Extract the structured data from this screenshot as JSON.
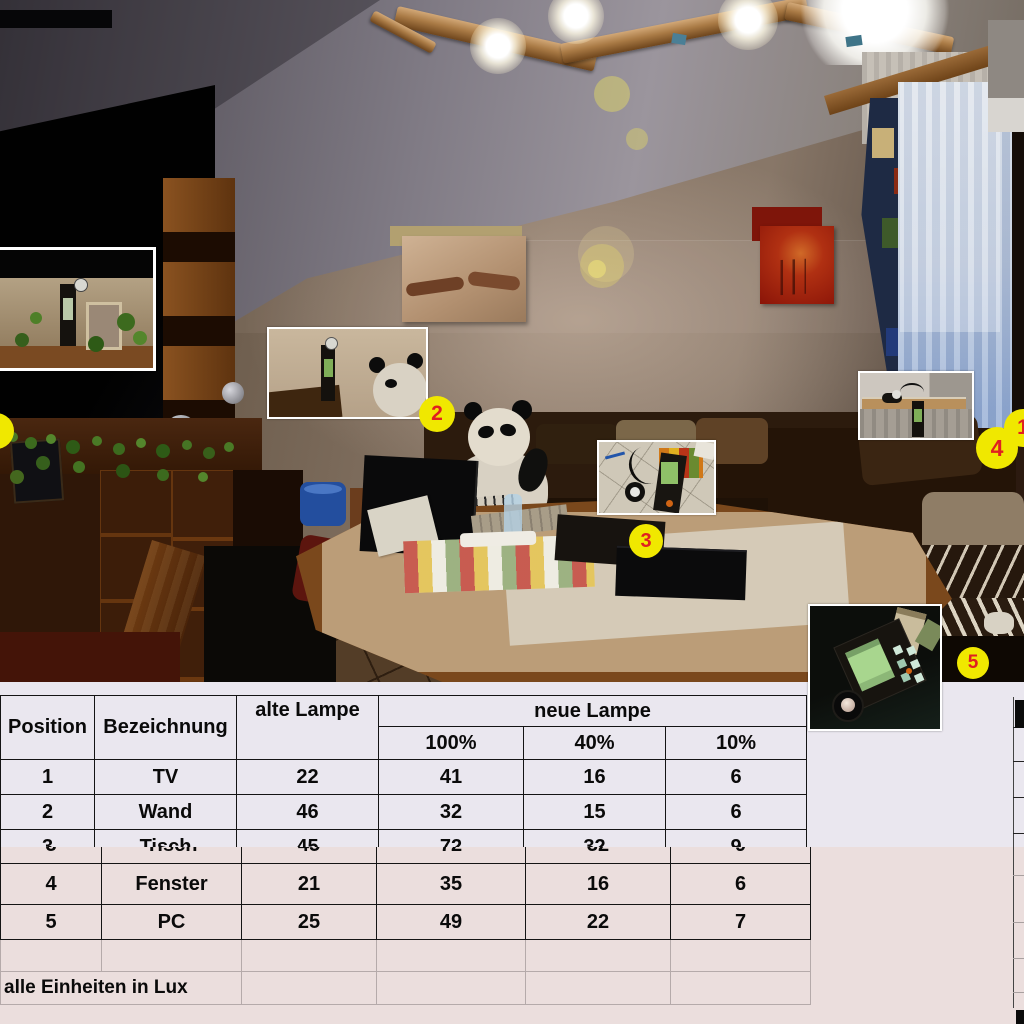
{
  "table": {
    "headers": {
      "position": "Position",
      "bezeichnung": "Bezeichnung",
      "alte_lampe": "alte Lampe",
      "neue_lampe": "neue Lampe",
      "sub": [
        "100%",
        "40%",
        "10%"
      ]
    },
    "rows": [
      {
        "position": "1",
        "bezeichnung": "TV",
        "alte": "22",
        "neue": [
          "41",
          "16",
          "6"
        ]
      },
      {
        "position": "2",
        "bezeichnung": "Wand",
        "alte": "46",
        "neue": [
          "32",
          "15",
          "6"
        ]
      },
      {
        "position": "3",
        "bezeichnung": "Tisch",
        "alte": "45",
        "neue": [
          "72",
          "32",
          "9"
        ]
      },
      {
        "position": "4",
        "bezeichnung": "Fenster",
        "alte": "21",
        "neue": [
          "35",
          "16",
          "6"
        ]
      },
      {
        "position": "5",
        "bezeichnung": "PC",
        "alte": "25",
        "neue": [
          "49",
          "22",
          "7"
        ]
      }
    ],
    "footnote": "alle Einheiten in Lux"
  },
  "markers": {
    "m1": "1",
    "m2": "2",
    "m3": "3",
    "m4": "4",
    "m5": "5"
  },
  "colors": {
    "marker_fill": "#f0e800",
    "marker_number": "#e02020",
    "upper_panel_bg": "#eae7ef",
    "lower_panel_bg": "#ebdedd",
    "table_border": "#141414"
  }
}
